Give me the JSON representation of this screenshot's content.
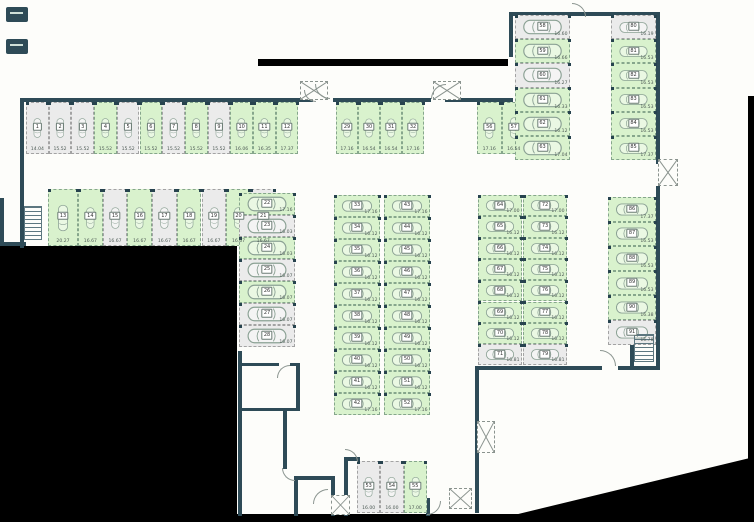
{
  "title": "parking-level-floor-plan",
  "palette": {
    "available_fill": "#d9f2cd",
    "occupied_fill": "#ebebeb",
    "wall_color": "#2e4b57",
    "void_color": "#000000",
    "plan_background": "#fdfdfa"
  },
  "icons": {
    "car": "car-icon",
    "stairs": "stairs-icon",
    "shaft": "shaft-cross-icon",
    "door": "door-arc-icon",
    "corner_marker": "corner-marker-icon"
  },
  "groups": [
    {
      "id": "g1",
      "spots": [
        {
          "n": "1",
          "m": "14.04",
          "s": "gray"
        },
        {
          "n": "2",
          "m": "15.52",
          "s": "gray"
        },
        {
          "n": "3",
          "m": "15.52",
          "s": "gray"
        },
        {
          "n": "4",
          "m": "15.52",
          "s": "green"
        },
        {
          "n": "5",
          "m": "15.52",
          "s": "gray"
        },
        {
          "n": "6",
          "m": "15.52",
          "s": "green"
        },
        {
          "n": "7",
          "m": "15.52",
          "s": "gray"
        },
        {
          "n": "8",
          "m": "15.52",
          "s": "green"
        },
        {
          "n": "9",
          "m": "15.52",
          "s": "gray"
        },
        {
          "n": "10",
          "m": "16.06",
          "s": "green"
        },
        {
          "n": "11",
          "m": "16.35",
          "s": "green"
        },
        {
          "n": "12",
          "m": "17.37",
          "s": "green"
        }
      ]
    },
    {
      "id": "g2",
      "spots": [
        {
          "n": "13",
          "m": "20.27",
          "s": "green"
        },
        {
          "n": "14",
          "m": "16.67",
          "s": "green"
        },
        {
          "n": "15",
          "m": "16.67",
          "s": "gray"
        },
        {
          "n": "16",
          "m": "16.67",
          "s": "green"
        },
        {
          "n": "17",
          "m": "16.67",
          "s": "gray"
        },
        {
          "n": "18",
          "m": "16.67",
          "s": "green"
        },
        {
          "n": "19",
          "m": "16.67",
          "s": "gray"
        },
        {
          "n": "20",
          "m": "16.67",
          "s": "green"
        },
        {
          "n": "21",
          "m": "16.67",
          "s": "gray"
        }
      ]
    },
    {
      "id": "g3",
      "spots": [
        {
          "n": "22",
          "m": "17.16",
          "s": "green"
        },
        {
          "n": "23",
          "m": "16.03",
          "s": "gray"
        },
        {
          "n": "24",
          "m": "16.03",
          "s": "green"
        },
        {
          "n": "25",
          "m": "16.07",
          "s": "gray"
        },
        {
          "n": "26",
          "m": "16.07",
          "s": "green"
        },
        {
          "n": "27",
          "m": "16.07",
          "s": "gray"
        },
        {
          "n": "28",
          "m": "16.07",
          "s": "gray"
        }
      ]
    },
    {
      "id": "g4",
      "spots": [
        {
          "n": "29",
          "m": "17.16",
          "s": "green"
        },
        {
          "n": "30",
          "m": "16.54",
          "s": "green"
        },
        {
          "n": "31",
          "m": "16.54",
          "s": "green"
        },
        {
          "n": "32",
          "m": "17.16",
          "s": "green"
        }
      ]
    },
    {
      "id": "g5L",
      "spots": [
        {
          "n": "33",
          "m": "17.16",
          "s": "green"
        },
        {
          "n": "34",
          "m": "16.12",
          "s": "green"
        },
        {
          "n": "35",
          "m": "16.12",
          "s": "green"
        },
        {
          "n": "36",
          "m": "16.12",
          "s": "green"
        },
        {
          "n": "37",
          "m": "16.12",
          "s": "green"
        },
        {
          "n": "38",
          "m": "16.12",
          "s": "green"
        },
        {
          "n": "39",
          "m": "16.12",
          "s": "green"
        },
        {
          "n": "40",
          "m": "16.12",
          "s": "green"
        },
        {
          "n": "41",
          "m": "16.12",
          "s": "green"
        },
        {
          "n": "42",
          "m": "17.16",
          "s": "green"
        }
      ]
    },
    {
      "id": "g5R",
      "spots": [
        {
          "n": "43",
          "m": "17.16",
          "s": "green"
        },
        {
          "n": "44",
          "m": "16.12",
          "s": "green"
        },
        {
          "n": "45",
          "m": "16.12",
          "s": "green"
        },
        {
          "n": "46",
          "m": "16.12",
          "s": "green"
        },
        {
          "n": "47",
          "m": "16.12",
          "s": "green"
        },
        {
          "n": "48",
          "m": "16.12",
          "s": "green"
        },
        {
          "n": "49",
          "m": "16.12",
          "s": "green"
        },
        {
          "n": "50",
          "m": "16.12",
          "s": "green"
        },
        {
          "n": "51",
          "m": "16.12",
          "s": "green"
        },
        {
          "n": "52",
          "m": "17.16",
          "s": "green"
        }
      ]
    },
    {
      "id": "g6",
      "spots": [
        {
          "n": "53",
          "m": "16.00",
          "s": "gray"
        },
        {
          "n": "54",
          "m": "16.00",
          "s": "gray"
        },
        {
          "n": "55",
          "m": "17.00",
          "s": "green"
        }
      ]
    },
    {
      "id": "g7",
      "spots": [
        {
          "n": "56",
          "m": "17.16",
          "s": "green"
        },
        {
          "n": "57",
          "m": "16.54",
          "s": "green"
        }
      ]
    },
    {
      "id": "g8",
      "spots": [
        {
          "n": "58",
          "m": "16.60",
          "s": "gray"
        },
        {
          "n": "59",
          "m": "16.66",
          "s": "green"
        },
        {
          "n": "60",
          "m": "16.27",
          "s": "gray"
        },
        {
          "n": "61",
          "m": "16.33",
          "s": "green"
        },
        {
          "n": "62",
          "m": "16.12",
          "s": "green"
        },
        {
          "n": "63",
          "m": "17.04",
          "s": "green"
        }
      ]
    },
    {
      "id": "g9L",
      "spots": [
        {
          "n": "64",
          "m": "17.00",
          "s": "green"
        },
        {
          "n": "65",
          "m": "16.12",
          "s": "green"
        },
        {
          "n": "66",
          "m": "16.12",
          "s": "green"
        },
        {
          "n": "67",
          "m": "16.12",
          "s": "green"
        },
        {
          "n": "68",
          "m": "16.12",
          "s": "green"
        },
        {
          "n": "69",
          "m": "16.12",
          "s": "green"
        },
        {
          "n": "70",
          "m": "16.12",
          "s": "green"
        },
        {
          "n": "71",
          "m": "16.81",
          "s": "gray"
        }
      ]
    },
    {
      "id": "g9R",
      "spots": [
        {
          "n": "72",
          "m": "17.00",
          "s": "green"
        },
        {
          "n": "73",
          "m": "16.12",
          "s": "green"
        },
        {
          "n": "74",
          "m": "16.12",
          "s": "green"
        },
        {
          "n": "75",
          "m": "16.12",
          "s": "green"
        },
        {
          "n": "76",
          "m": "16.12",
          "s": "green"
        },
        {
          "n": "77",
          "m": "16.12",
          "s": "green"
        },
        {
          "n": "78",
          "m": "16.12",
          "s": "green"
        },
        {
          "n": "79",
          "m": "16.81",
          "s": "gray"
        }
      ]
    },
    {
      "id": "g10",
      "spots": [
        {
          "n": "80",
          "m": "16.19",
          "s": "gray"
        },
        {
          "n": "81",
          "m": "16.53",
          "s": "green"
        },
        {
          "n": "82",
          "m": "16.53",
          "s": "green"
        },
        {
          "n": "83",
          "m": "16.53",
          "s": "green"
        },
        {
          "n": "84",
          "m": "16.53",
          "s": "green"
        },
        {
          "n": "85",
          "m": "17.37",
          "s": "green"
        }
      ]
    },
    {
      "id": "g11",
      "spots": [
        {
          "n": "86",
          "m": "17.37",
          "s": "green"
        },
        {
          "n": "87",
          "m": "16.53",
          "s": "green"
        },
        {
          "n": "88",
          "m": "16.53",
          "s": "green"
        },
        {
          "n": "89",
          "m": "16.53",
          "s": "green"
        },
        {
          "n": "90",
          "m": "16.38",
          "s": "green"
        },
        {
          "n": "91",
          "m": "16.78",
          "s": "gray"
        }
      ]
    }
  ]
}
